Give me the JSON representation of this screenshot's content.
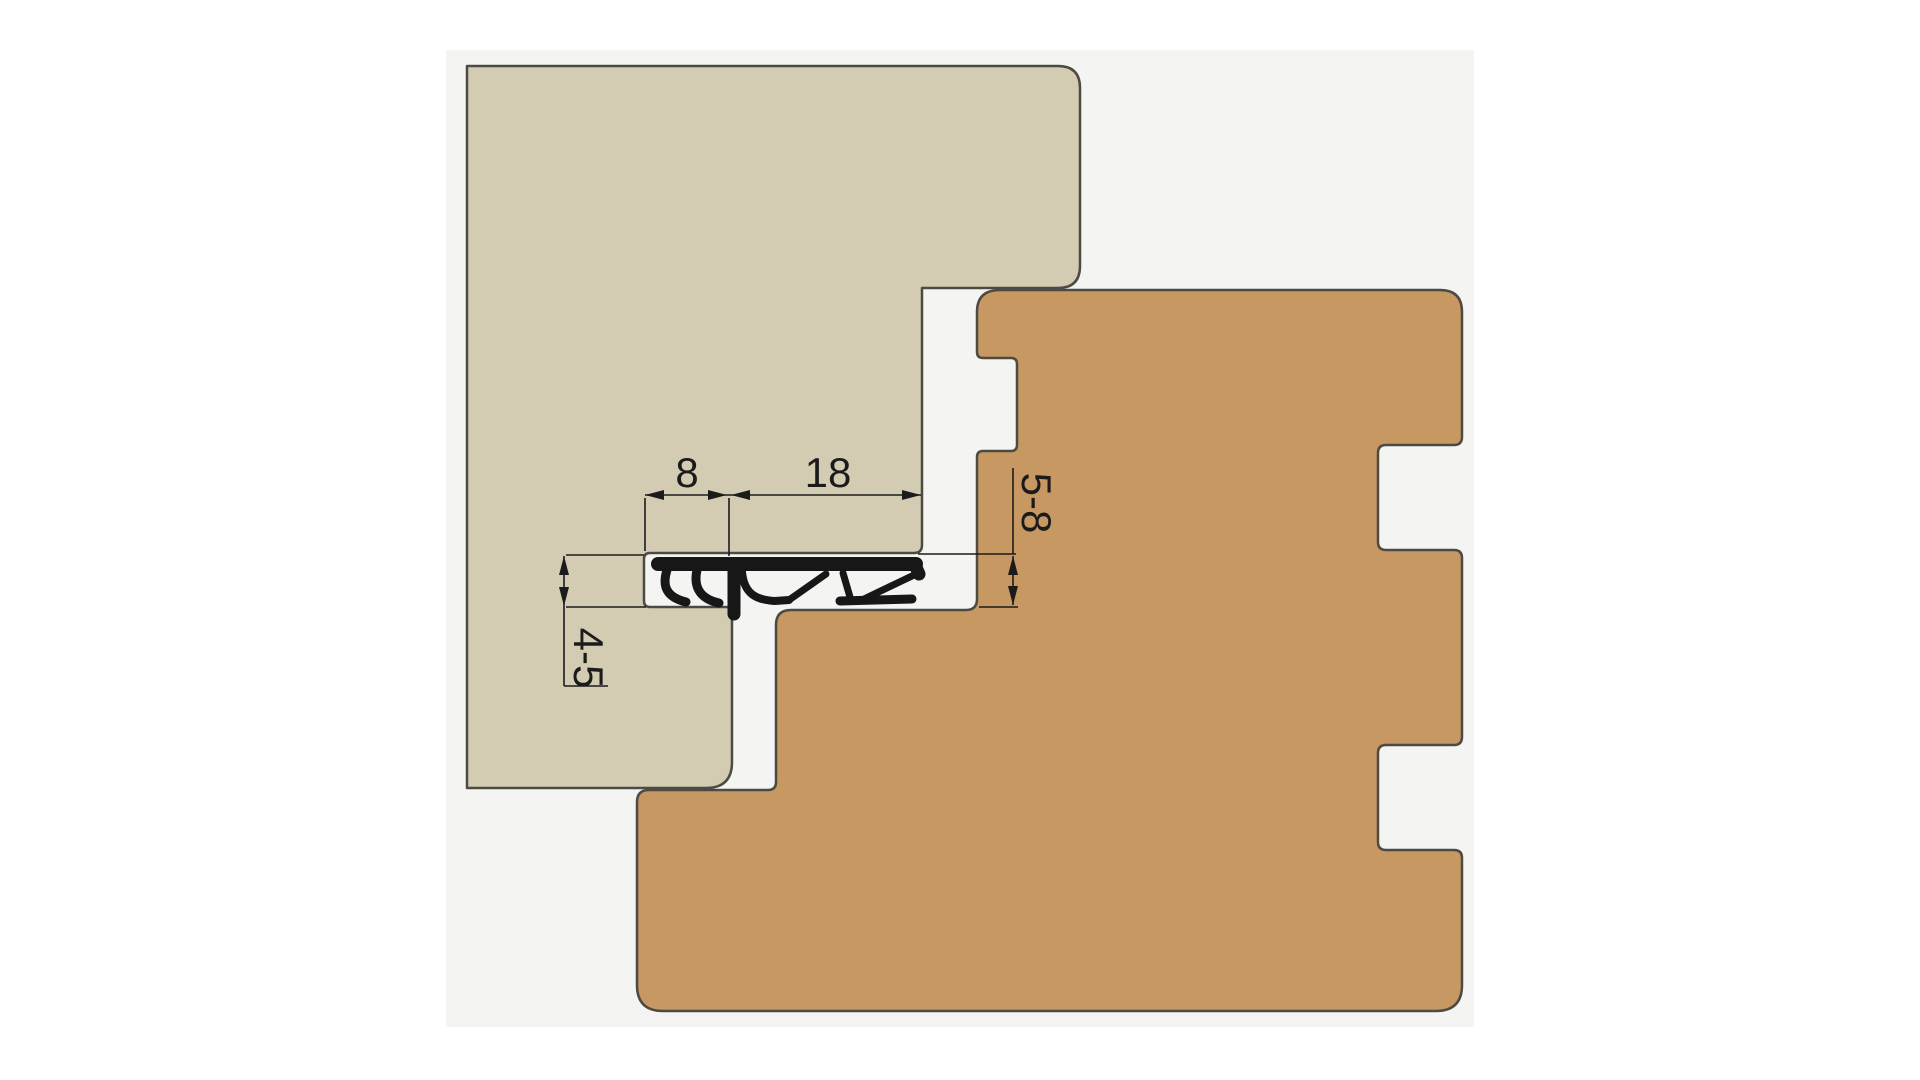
{
  "drawing": {
    "type": "technical-cross-section",
    "dimensions": {
      "groove_lip_width": "8",
      "seal_width": "18",
      "frame_gap_height": "4-5",
      "door_rebate_gap": "5-8"
    },
    "colors": {
      "page": "#ffffff",
      "canvas": "#f4f4f2",
      "frame": "#d3ccb2",
      "door": "#c79862",
      "seal": "#171717",
      "outline": "#4c4a42",
      "dimension": "#1b1b1b"
    }
  }
}
